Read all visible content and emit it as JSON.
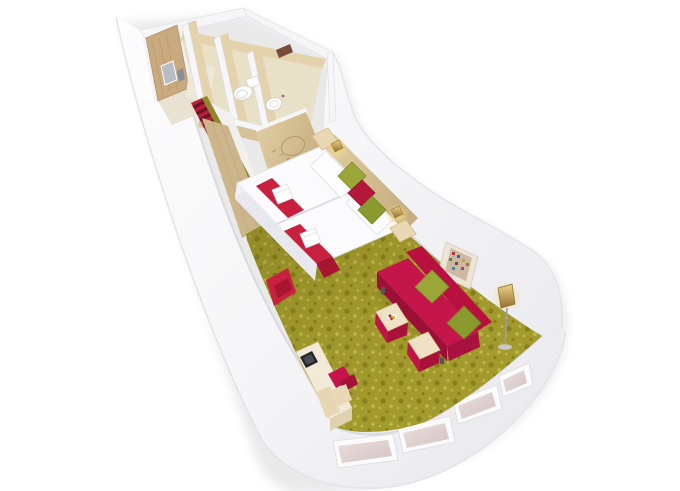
{
  "scene": {
    "kind": "3d-cabin-floorplan-render",
    "objects": [
      "hull",
      "entrance-door",
      "door-plaque",
      "corridor-runner",
      "wardrobe",
      "sketch-panel",
      "bathroom",
      "toilet",
      "washbasin",
      "towel-shelf",
      "twin-beds",
      "bed-runners",
      "towels",
      "decorative-cushions",
      "nightstands",
      "reading-lamps",
      "red-floor-throw",
      "desk",
      "tv",
      "desk-chair",
      "sofa",
      "sofa-cushions",
      "coffee-table",
      "fruit-bowl",
      "ottoman",
      "floor-lamp",
      "wall-artwork",
      "carpet",
      "panorama-windows"
    ]
  },
  "colors": {
    "background": "#ffffff",
    "hull_white": "#f8f8fa",
    "hull_edge": "#dfdfe5",
    "wall_face": "#f3f3f6",
    "wall_cap": "#f6f6f8",
    "wood_door": "#c9a97e",
    "wood_wall": "#e3d2ac",
    "wood_panel": "#d6c29a",
    "wood_dark": "#cdb58b",
    "bath_floor": "#e9e0c8",
    "entry_floor": "#e9e2d2",
    "corridor_floor": "#f1f0ec",
    "carpet_base": "#a39b2d",
    "carpet_dot_dark": "#877e1c",
    "carpet_dot_light": "#c2b84e",
    "stripe_red": "#b42038",
    "stripe_dark": "#6d1322",
    "olive_edge": "#8f882a",
    "runner_red": "#c8203f",
    "runner_dark": "#a8152f",
    "towel": "#ffffff",
    "bed_white": "#fbfbfd",
    "bed_shadow": "#e8e8ee",
    "pillow_white": "#fdfdff",
    "cushion_green": "#9aa636",
    "cushion_green_dark": "#8a9a2e",
    "cushion_red": "#b5173b",
    "sofa_red": "#c5164b",
    "sofa_red_dark": "#9c0f37",
    "sofa_red_deep": "#b8113f",
    "table_wood": "#efe2c4",
    "desk_wood": "#f2ead6",
    "accent_red_base": "#c01445",
    "lamp_gold": "#d9b267",
    "lamp_gold_dark": "#93702f",
    "metal_gray": "#9a9aa2",
    "tv_dark": "#232327",
    "window_glass": "#e2d2d1",
    "window_frame": "#fbfbfc",
    "art_frame": "#ece5d6",
    "art_canvas": "#cbb9a4",
    "fixture_white": "#fdfdfd",
    "shelf_brown": "#7a4a3a",
    "sketch_line": "#b49a6e"
  }
}
